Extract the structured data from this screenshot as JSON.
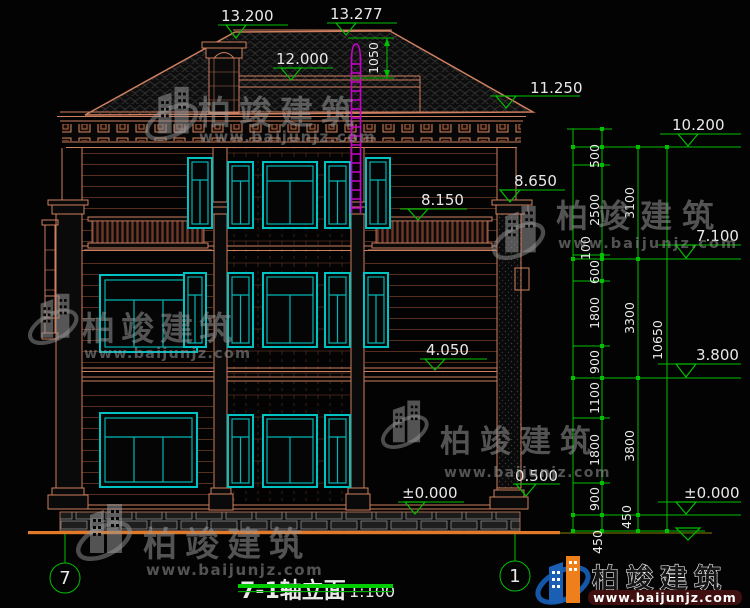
{
  "title_block": {
    "title": "7-1轴立面",
    "scale": "1:100"
  },
  "axes": {
    "left": "7",
    "right": "1"
  },
  "elevations": {
    "ridge": "13.200",
    "ladder_top": "13.277",
    "tower_parapet": "12.000",
    "right_eave": "11.250",
    "eave_right_chain": "10.200",
    "pilaster_top": "8.650",
    "balcony_rail": "8.150",
    "level3_right_chain": "7.100",
    "floor2_band": "4.050",
    "level1_right_chain": "3.800",
    "ground_building": "±0.000",
    "ground_right_chain": "±0.000",
    "plinth": "0.500"
  },
  "dimensions": {
    "ladder_height": "1050",
    "chain_inner": [
      "500",
      "2500",
      "100",
      "600",
      "1800",
      "900",
      "1100",
      "1800",
      "900",
      "450"
    ],
    "chain_mid": [
      "3100",
      "3300",
      "3800",
      "450"
    ],
    "chain_total": "10650"
  },
  "watermark": {
    "name": "柏竣建筑",
    "url": "www.baijunjz.com"
  },
  "logo": {
    "name": "柏竣建筑",
    "url": "www.baijunjz.com"
  },
  "colors": {
    "line": "#cd7f5f",
    "window": "#00b6b6",
    "dimension": "#00c000",
    "ladder": "#cc00cc",
    "ground": "#e07a28",
    "logo_blue": "#1a5fb4",
    "logo_orange": "#ef7f1a"
  }
}
